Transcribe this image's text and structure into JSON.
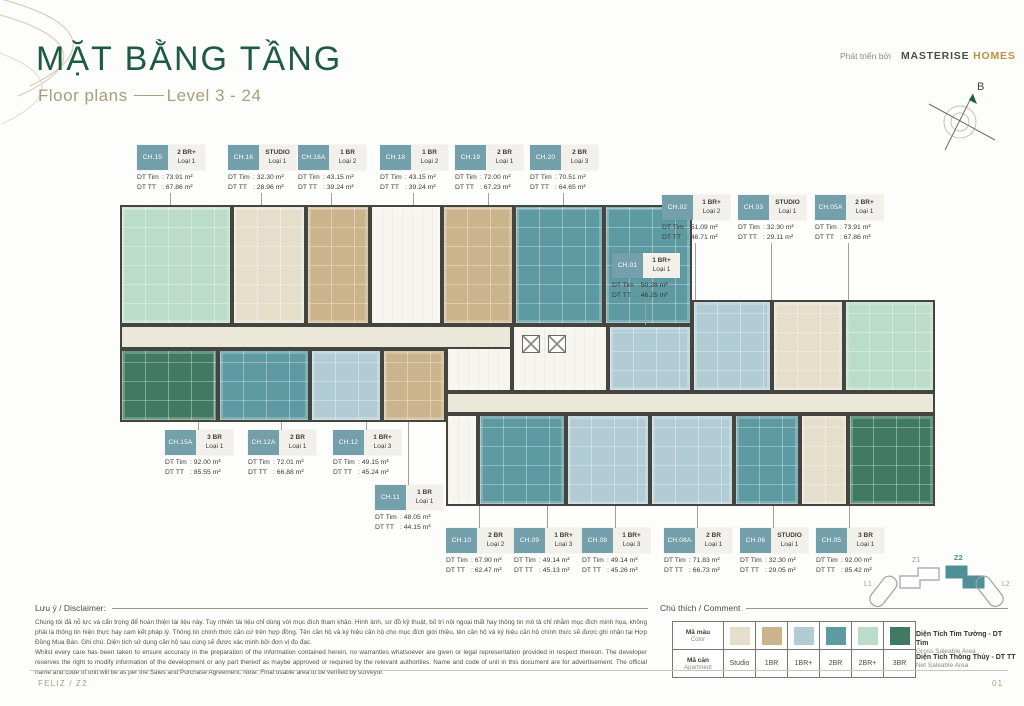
{
  "theme": {
    "green": "#1d5b44",
    "gold": "#bd9040",
    "tan": "#a99e77",
    "chip": "#73a0ab"
  },
  "header": {
    "title": "MẶT BẰNG TẦNG",
    "subtitle_left": "Floor plans",
    "subtitle_right": "Level 3 - 24",
    "developer_prefix": "Phát triển bởi",
    "brand_name": "MASTERISE",
    "brand_suffix": "HOMES",
    "compass_label": "B"
  },
  "plan": {
    "area_prefix_gross": "DT Tim",
    "area_prefix_net": "DT TT",
    "area_unit": "m²",
    "units": [
      {
        "code": "CH.15",
        "type": "2BR+",
        "type_label": "2 BR+",
        "loai": "Loại 1",
        "tim": "73.91",
        "tt": "67.86"
      },
      {
        "code": "CH.16",
        "type": "STUDIO",
        "type_label": "STUDIO",
        "loai": "Loại 1",
        "tim": "32.30",
        "tt": "28.96"
      },
      {
        "code": "CH.16A",
        "type": "1BR",
        "type_label": "1 BR",
        "loai": "Loại 2",
        "tim": "43.15",
        "tt": "39.24"
      },
      {
        "code": "CH.18",
        "type": "1BR",
        "type_label": "1 BR",
        "loai": "Loại 2",
        "tim": "43.15",
        "tt": "39.24"
      },
      {
        "code": "CH.19",
        "type": "2BR",
        "type_label": "2 BR",
        "loai": "Loại 1",
        "tim": "72.00",
        "tt": "67.23"
      },
      {
        "code": "CH.20",
        "type": "2BR",
        "type_label": "2 BR",
        "loai": "Loại 3",
        "tim": "70.51",
        "tt": "64.65"
      },
      {
        "code": "CH.02",
        "type": "1BR+",
        "type_label": "1 BR+",
        "loai": "Loại 2",
        "tim": "51.09",
        "tt": "46.71"
      },
      {
        "code": "CH.03",
        "type": "STUDIO",
        "type_label": "STUDIO",
        "loai": "Loại 1",
        "tim": "32.30",
        "tt": "29.11"
      },
      {
        "code": "CH.05A",
        "type": "2BR+",
        "type_label": "2 BR+",
        "loai": "Loại 1",
        "tim": "73.91",
        "tt": "67.86"
      },
      {
        "code": "CH.01",
        "type": "1BR+",
        "type_label": "1 BR+",
        "loai": "Loại 1",
        "tim": "50.28",
        "tt": "46.25"
      },
      {
        "code": "CH.15A",
        "type": "3BR",
        "type_label": "3 BR",
        "loai": "Loại 1",
        "tim": "92.00",
        "tt": "85.55"
      },
      {
        "code": "CH.12A",
        "type": "2BR",
        "type_label": "2 BR",
        "loai": "Loại 1",
        "tim": "72.01",
        "tt": "66.88"
      },
      {
        "code": "CH.12",
        "type": "1BR+",
        "type_label": "1 BR+",
        "loai": "Loại 3",
        "tim": "49.15",
        "tt": "45.24"
      },
      {
        "code": "CH.11",
        "type": "1BR",
        "type_label": "1 BR",
        "loai": "Loại 1",
        "tim": "48.05",
        "tt": "44.15"
      },
      {
        "code": "CH.10",
        "type": "2BR",
        "type_label": "2 BR",
        "loai": "Loại 2",
        "tim": "67.90",
        "tt": "62.47"
      },
      {
        "code": "CH.09",
        "type": "1BR+",
        "type_label": "1 BR+",
        "loai": "Loại 3",
        "tim": "49.14",
        "tt": "45.13"
      },
      {
        "code": "CH.08",
        "type": "1BR+",
        "type_label": "1 BR+",
        "loai": "Loại 3",
        "tim": "49.14",
        "tt": "45.26"
      },
      {
        "code": "CH.08A",
        "type": "2BR",
        "type_label": "2 BR",
        "loai": "Loại 1",
        "tim": "71.83",
        "tt": "66.73"
      },
      {
        "code": "CH.06",
        "type": "STUDIO",
        "type_label": "STUDIO",
        "loai": "Loại 1",
        "tim": "32.30",
        "tt": "29.05"
      },
      {
        "code": "CH.05",
        "type": "3BR",
        "type_label": "3 BR",
        "loai": "Loại 1",
        "tim": "92.00",
        "tt": "85.42"
      }
    ]
  },
  "legend": {
    "heading": "Chú thích / Comment",
    "row1_label": "Mã màu",
    "row1_sub": "Color",
    "row2_label": "Mã căn",
    "row2_sub": "Apartment",
    "types": [
      {
        "key": "STUDIO",
        "label": "Studio",
        "color": "#e5decb"
      },
      {
        "key": "1BR",
        "label": "1BR",
        "color": "#cbb48c"
      },
      {
        "key": "1BR+",
        "label": "1BR+",
        "color": "#b2ccd6"
      },
      {
        "key": "2BR",
        "label": "2BR",
        "color": "#5e9aa2"
      },
      {
        "key": "2BR+",
        "label": "2BR+",
        "color": "#bcdcca"
      },
      {
        "key": "3BR",
        "label": "3BR",
        "color": "#417a63"
      }
    ],
    "gross": {
      "title": "Diện Tích Tim Tường - DT Tim",
      "sub": "Gross Saleable Area"
    },
    "net": {
      "title": "Diện Tích Thông Thủy - DT TT",
      "sub": "Net Saleable Area"
    }
  },
  "minimap": {
    "l1": "L1",
    "z1": "Z1",
    "z2": "Z2",
    "l2": "L2"
  },
  "disclaimer": {
    "heading": "Lưu ý / Disclaimer:",
    "vi": "Chúng tôi đã nỗ lực và cẩn trọng để hoàn thiện tài liệu này. Tuy nhiên tài liệu chỉ dùng với mục đích tham khảo. Hình ảnh, sơ đồ kỹ thuật, bố trí nội ngoại thất hay thông tin mô tả chỉ nhằm mục đích minh họa, không phải là thông tin hiện thực hay cam kết pháp lý. Thông tin chính thức căn cứ trên hợp đồng. Tên căn hộ và ký hiệu căn hộ cho mục đích giới thiệu, tên căn hộ và ký hiệu căn hộ chính thức sẽ được ghi nhận tại Hợp Đồng Mua Bán. Ghi chú: Diện tích sử dụng căn hộ sau cùng sẽ được xác minh bởi đơn vị đo đạc.",
    "en": "Whilst every care has been taken to ensure accuracy in the preparation of the information contained herein, no warranties whatsoever are given or legal representation provided in respect thereon. The developer reserves the right to modify information of the development or any part thereof as maybe approved or required by the relevant authorities. Name and code of unit in this document are for advertisement. The official name and code of unit will be as per the Sales and Purchase Agreement. Note: Final usable area to be verified by surveyor."
  },
  "footer": {
    "left": "FELIZ / Z2",
    "right": "01"
  }
}
